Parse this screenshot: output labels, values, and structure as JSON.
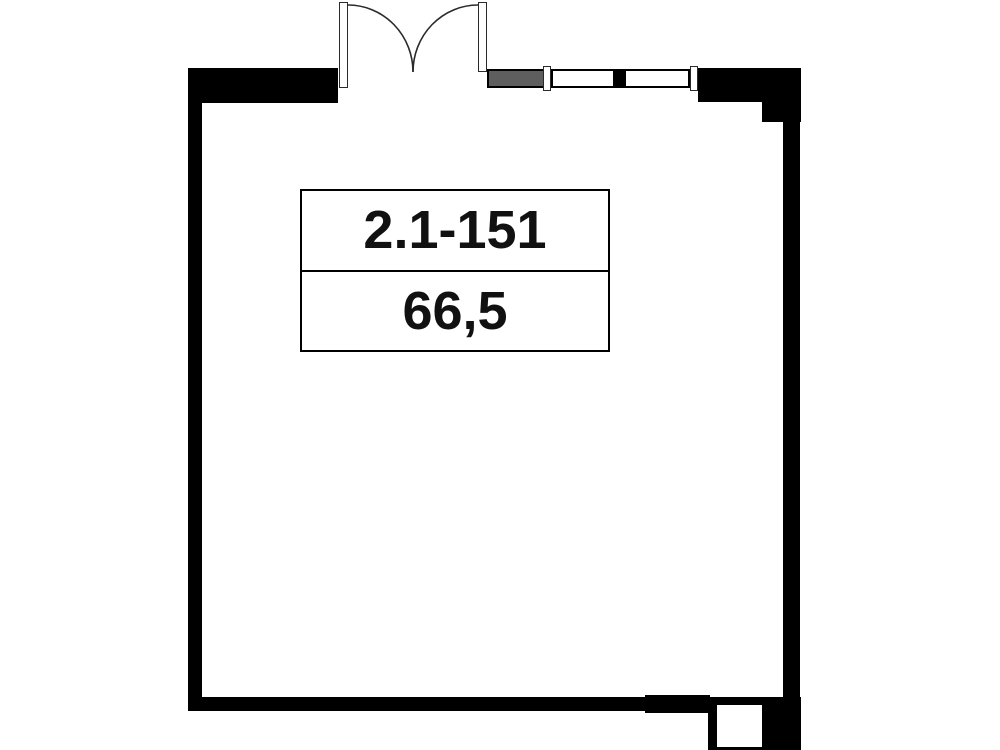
{
  "unit": {
    "number": "2.1-151",
    "area": "66,5"
  },
  "colors": {
    "wall": "#000000",
    "background": "#ffffff",
    "gray_segment": "#5e5e5e",
    "text": "#111111",
    "line": "#2a2a2a"
  },
  "plan": {
    "type": "single-room floor plan",
    "features": [
      "double-entry-door-top",
      "gray-wall-segment",
      "two-window-segments",
      "stepped-top-right-corner",
      "shaft-opening-bottom-right"
    ]
  }
}
